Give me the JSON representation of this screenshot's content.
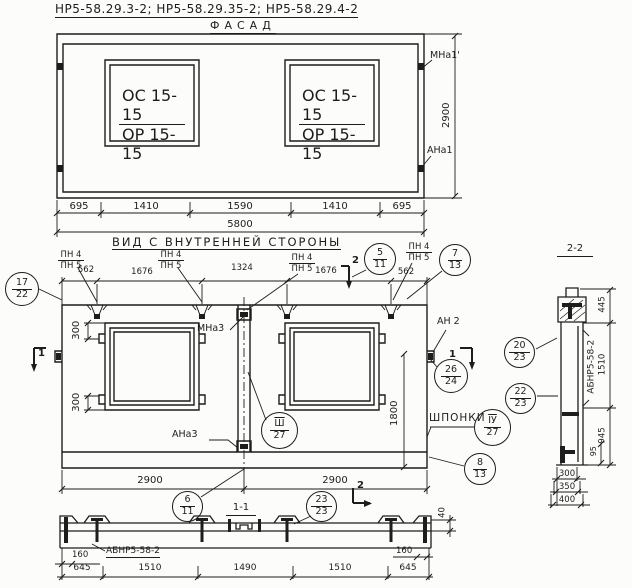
{
  "sheet": {
    "title": "НР5-58.29.3-2;  НР5-58.29.35-2;  НР5-58.29.4-2"
  },
  "facade": {
    "heading": "ФАСАД",
    "window_mark_top": "ОС 15-15",
    "window_mark_bottom": "ОР 15-15",
    "anchor_top": "МНа1'",
    "anchor_bottom": "АНа1",
    "height": "2900",
    "widths": [
      "695",
      "1410",
      "1590",
      "1410",
      "695"
    ],
    "total_width": "5800"
  },
  "inner": {
    "heading": "ВИД С ВНУТРЕННЕЙ СТОРОНЫ",
    "pn_top": "ПН 4",
    "pn_bottom": "ПН 5",
    "top_widths": [
      "562",
      "1676",
      "1324",
      "1676",
      "562"
    ],
    "offset_top": "300",
    "offset_bottom": "300",
    "anchor_mid_top": "МНа3",
    "anchor_mid_bottom": "АНа3",
    "anchor_right": "АН 2",
    "keys_label": "ШПОНКИ",
    "opening_height": "1800",
    "half_widths": [
      "2900",
      "2900"
    ],
    "rib_height": "40"
  },
  "balloons": {
    "b17_22": {
      "top": "17",
      "bottom": "22"
    },
    "b5_11": {
      "top": "5",
      "bottom": "11"
    },
    "b7_13": {
      "top": "7",
      "bottom": "13"
    },
    "b26_24": {
      "top": "26",
      "bottom": "24"
    },
    "b20_23": {
      "top": "20",
      "bottom": "23"
    },
    "b22_23": {
      "top": "22",
      "bottom": "23"
    },
    "b3_27": {
      "top": "Ш",
      "bottom": "27"
    },
    "b4_27": {
      "top": "ІУ",
      "bottom": "27"
    },
    "b8_13": {
      "top": "8",
      "bottom": "13"
    },
    "b6_11": {
      "top": "6",
      "bottom": "11"
    },
    "b23_23": {
      "top": "23",
      "bottom": "23"
    }
  },
  "marks": {
    "section1": "1",
    "section2": "2"
  },
  "section11": {
    "heading": "1-1",
    "beam_label": "АБНР5-58-2",
    "end_offset_left": "160",
    "end_offset_right": "160",
    "widths": [
      "645",
      "1510",
      "1490",
      "1510",
      "645"
    ]
  },
  "section22": {
    "heading": "2-2",
    "beam_label": "АБНР5-58-2",
    "heights": [
      "445",
      "1510",
      "945"
    ],
    "anchor_offset": "95",
    "depths": [
      "300",
      "350",
      "400"
    ]
  }
}
